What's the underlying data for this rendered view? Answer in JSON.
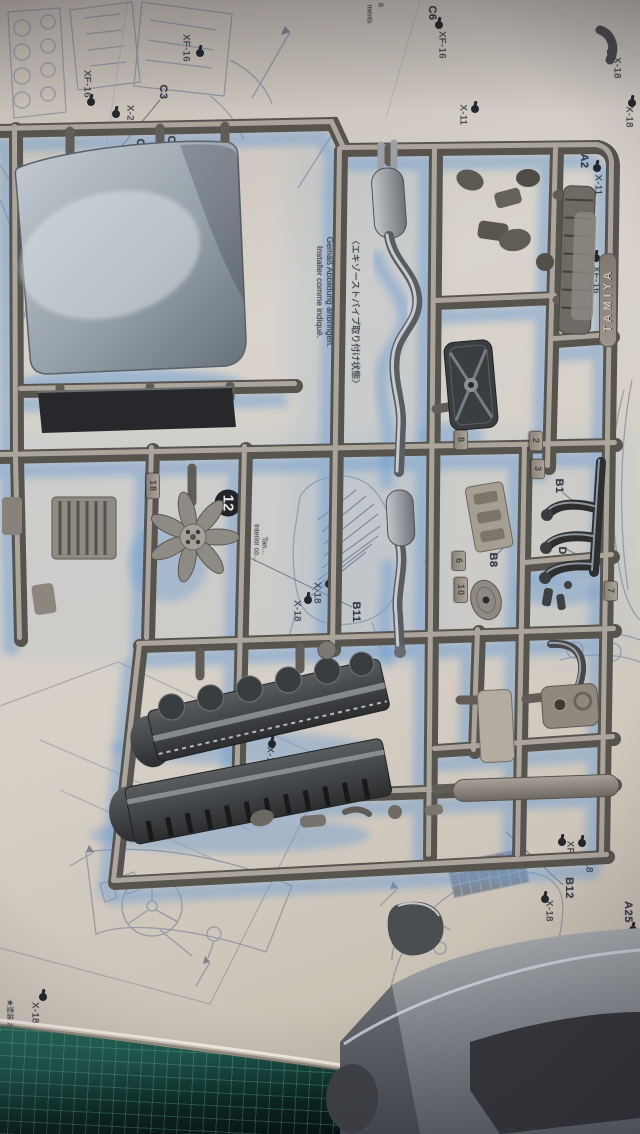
{
  "colors": {
    "paper": "#d6d0c8",
    "shadow_blue": "#6f9ed2",
    "sprue_grey": "#8a867e",
    "sprue_dark": "#57544e",
    "part_dark": "#2e3032",
    "hood_grey": "#9aa3ab",
    "mat_green": "#1d554a",
    "body_grey": "#8e9296",
    "ink": "#343b47"
  },
  "labels": {
    "part_refs": [
      {
        "code": "C6"
      },
      {
        "code": "C3"
      },
      {
        "code": "C2"
      },
      {
        "code": "C1"
      },
      {
        "code": "A2"
      },
      {
        "code": "B1"
      },
      {
        "code": "D2"
      },
      {
        "code": "B8"
      },
      {
        "code": "B11"
      },
      {
        "code": "B12"
      },
      {
        "code": "A25"
      }
    ],
    "paint_marks": [
      {
        "code": "XF-16"
      },
      {
        "code": "XF-16"
      },
      {
        "code": "X-2"
      },
      {
        "code": "XF-16"
      },
      {
        "code": "X-18"
      },
      {
        "code": "X-18"
      },
      {
        "code": "X-11"
      },
      {
        "code": "X-11"
      },
      {
        "code": "XF-16"
      },
      {
        "code": "X-18"
      },
      {
        "code": "X-18"
      },
      {
        "code": "X-11"
      },
      {
        "code": "X-18"
      },
      {
        "code": "XF-1"
      },
      {
        "code": "X-18"
      },
      {
        "code": "X-18"
      },
      {
        "code": "X-18"
      }
    ]
  },
  "notes": {
    "exhaust": {
      "jp": "〈エキゾーストパイプ取り付け状態〉",
      "en": "Attach as shown.",
      "de": "Gemäß Abbildung anbringen.",
      "fr": "Installer comme indiqué."
    },
    "step_number": "12",
    "step_note_lines": [
      "メーカー…",
      "Interior co…",
      "Tan…"
    ],
    "footnote": "★塗装はB17と同様",
    "page_fragment": [
      "ments",
      "8"
    ]
  },
  "sprue": {
    "brand": "TAMIYA",
    "tags": [
      "18",
      "8",
      "2",
      "3",
      "6",
      "10",
      "7"
    ]
  }
}
